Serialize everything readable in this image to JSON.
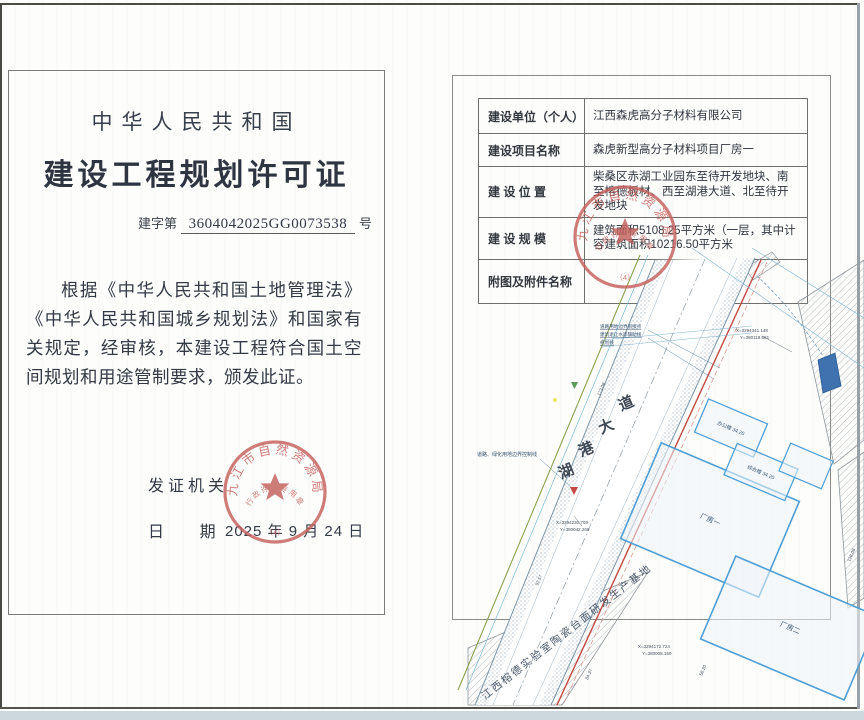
{
  "left_page": {
    "country": "中华人民共和国",
    "title": "建设工程规划许可证",
    "permit_no_prefix": "建字第",
    "permit_no": "3604042025GG0073538",
    "permit_no_suffix": "号",
    "body": "根据《中华人民共和国土地管理法》《中华人民共和国城乡规划法》和国家有关规定，经审核，本建设工程符合国土空间规划和用途管制要求，颁发此证。",
    "issuer_label": "发证机关",
    "date_label": "日        期",
    "date_value": "2025 年 9 月 24 日"
  },
  "seal": {
    "org": "九江市自然资源局",
    "type": "行政许可专用章",
    "number": "（4）"
  },
  "right_page": {
    "table": {
      "rows": [
        {
          "label": "建设单位（个人）",
          "value": "江西森虎高分子材料有限公司"
        },
        {
          "label": "建设项目名称",
          "value": "森虎新型高分子材料项目厂房一"
        },
        {
          "label": "建 设 位 置",
          "value": "柴桑区赤湖工业园东至待开发地块、南至榕德板材、西至湖港大道、北至待开发地块"
        },
        {
          "label": "建 设 规 模",
          "value": "建筑面积5108.25平方米（一层，其中计容建筑面积10216.50平方米"
        },
        {
          "label": "附图及附件名称",
          "value": ""
        }
      ]
    },
    "map": {
      "road_name": "湖港大道",
      "road_name_chars": [
        "道",
        "大",
        "港",
        "湖"
      ],
      "site_label": "江西榕德实验室陶瓷台面研发生产基地",
      "buildings": [
        {
          "label": "厂房一"
        },
        {
          "label": "厂房二"
        },
        {
          "label": "办公楼 34.20"
        },
        {
          "label": "综合楼 34.20"
        }
      ],
      "coords": [
        {
          "x": "X=3294341.148",
          "y": "Y=380118.561"
        },
        {
          "x": "X=3294230.709",
          "y": "Y=380042.269"
        },
        {
          "x": "X=3294172.724",
          "y": "Y=380008.150"
        }
      ],
      "callouts_top": [
        "道路用地边界衔接点",
        "建筑退让水岸辅助线",
        "规划线"
      ],
      "callout_left": "道路、绿化用地边界控制线",
      "dims": [
        "173.08",
        "92.57",
        "84.37",
        "128.08",
        "58.20"
      ]
    }
  },
  "colors": {
    "seal_red": "#c4605c",
    "plan_blue": "#4d9fd6",
    "boundary_red": "#c44742",
    "road_green": "#8aa050"
  }
}
